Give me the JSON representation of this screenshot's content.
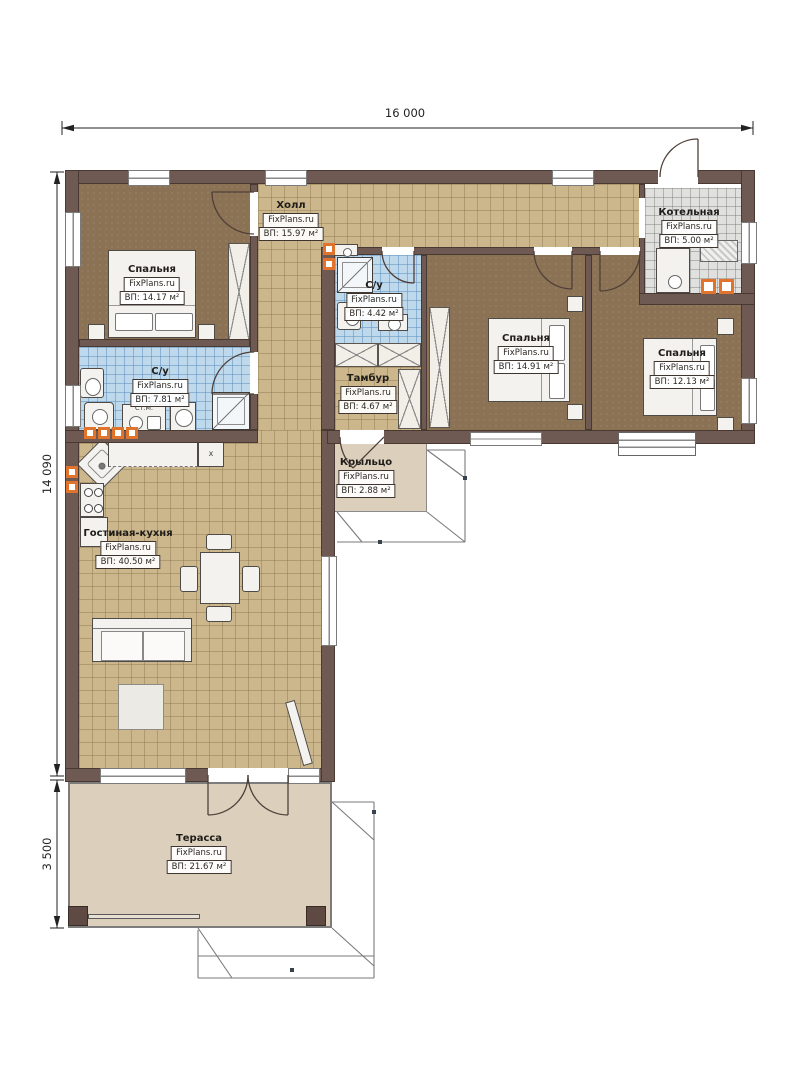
{
  "dimensions": {
    "width_total": "16 000",
    "height_total": "14 090",
    "terrace_height": "3 500"
  },
  "watermark": "FixPlans.ru",
  "rooms": {
    "bedroom1": {
      "name": "Спальня",
      "area": "ВП: 14.17 м²"
    },
    "hall": {
      "name": "Холл",
      "area": "ВП: 15.97 м²"
    },
    "bath_small": {
      "name": "С/у",
      "area": "ВП: 4.42 м²"
    },
    "boiler": {
      "name": "Котельная",
      "area": "ВП: 5.00 м²"
    },
    "bedroom2": {
      "name": "Спальня",
      "area": "ВП: 14.91 м²"
    },
    "bedroom3": {
      "name": "Спальня",
      "area": "ВП: 12.13 м²"
    },
    "bath_big": {
      "name": "С/у",
      "area": "ВП: 7.81 м²"
    },
    "tambour": {
      "name": "Тамбур",
      "area": "ВП: 4.67 м²"
    },
    "porch": {
      "name": "Крыльцо",
      "area": "ВП: 2.88 м²"
    },
    "living": {
      "name": "Гостиная-кухня",
      "area": "ВП: 40.50 м²"
    },
    "terrace": {
      "name": "Терасса",
      "area": "ВП: 21.67 м²"
    }
  },
  "annotations": {
    "washing_machine": "Ст.М.",
    "cabinet_mark": "x"
  }
}
